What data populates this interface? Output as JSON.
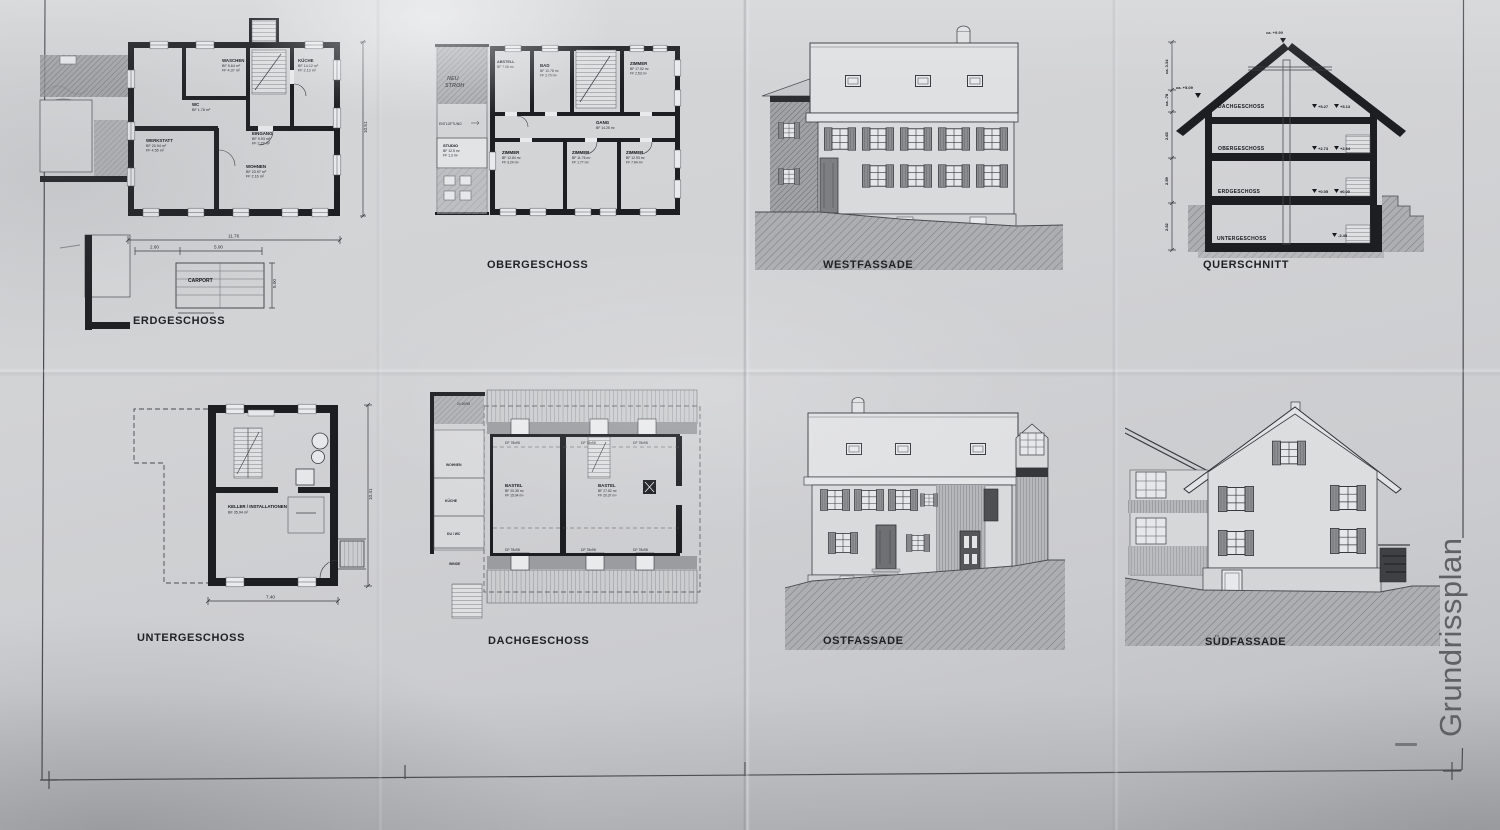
{
  "page": {
    "vertical_title": "Grundrissplan"
  },
  "erdgeschoss": {
    "title": "ERDGESCHOSS",
    "carport": "CARPORT",
    "rooms": {
      "waschen": {
        "name": "WASCHEN",
        "a": "BF 5.64 m²",
        "b": "FF 4.37 m²"
      },
      "kueche": {
        "name": "KÜCHE",
        "a": "BF 14.12 m²",
        "b": "FF 2.13 m²"
      },
      "wc": {
        "name": "WC",
        "a": "BF 1.78 m²"
      },
      "eingang": {
        "name": "EINGANG",
        "a": "BF 9.93 m²",
        "b": "FF 2.27 m²"
      },
      "werkstatt": {
        "name": "WERKSTATT",
        "a": "BF 20.94 m²",
        "b": "FF 4.55 m²"
      },
      "wohnen": {
        "name": "WOHNEN",
        "a": "BF 23.97 m²",
        "b": "FF 2.16 m²"
      }
    },
    "dims": {
      "total": "11.76",
      "left": "2.60",
      "mid": "5.00",
      "right_height": "10.51",
      "carport_depth": "5.00"
    }
  },
  "obergeschoss": {
    "title": "OBERGESCHOSS",
    "rooms": {
      "abstell": {
        "name": "ABSTELL",
        "a": "BF 7.08 m²"
      },
      "bad": {
        "name": "BAD",
        "a": "BF 10.78 m²",
        "b": "FF 2.70 m²"
      },
      "zno": {
        "name": "ZIMMER",
        "a": "BF 17.52 m²",
        "b": "FF 2.53 m²"
      },
      "gang": {
        "name": "GANG",
        "a": "BF 14.25 m²"
      },
      "z1": {
        "name": "ZIMMER",
        "a": "BF 12.84 m²",
        "b": "FF 3.24 m²"
      },
      "z2": {
        "name": "ZIMMER",
        "a": "BF 11.76 m²",
        "b": "FF 1.77 m²"
      },
      "z3": {
        "name": "ZIMMER",
        "a": "BF 12.93 m²",
        "b": "FF 7.94 m²"
      },
      "studio": {
        "name": "STUDIO",
        "a": "BF 12.5 m²",
        "b": "FF 1.3 m²"
      }
    },
    "notes": {
      "line1": "NEU",
      "line2": "STROH",
      "ent": "ENTLÜFTUNG"
    }
  },
  "westfassade": {
    "title": "WESTFASSADE"
  },
  "querschnitt": {
    "title": "QUERSCHNITT",
    "floors": {
      "dach": "DACHGESCHOSS",
      "ober": "OBERGESCHOSS",
      "erd": "ERDGESCHOSS",
      "unter": "UNTERGESCHOSS"
    },
    "levels": {
      "ridge": "ca. +9.99",
      "eaves": "ca. +5.09",
      "dach_a": "+5.27",
      "dach_b": "+5.13",
      "ober_a": "+2.73",
      "ober_b": "+2.64",
      "erd_a": "+0.05",
      "erd_b": "±0.00",
      "unter": "-2.45"
    },
    "dims": {
      "roof": "ca. 3.34",
      "knee": "ca. .78",
      "d1": "2.65",
      "d2": "2.59",
      "d3": "2.52"
    }
  },
  "untergeschoss": {
    "title": "UNTERGESCHOSS",
    "room": {
      "name": "KELLER / INSTALLATIONEN",
      "a": "BF 35.94 m²"
    },
    "dims": {
      "width": "7.40",
      "height": "10.41"
    }
  },
  "dachgeschoss": {
    "title": "DACHGESCHOSS",
    "window_label": "DF 78x98",
    "note_top": "2x 60/98",
    "rooms": {
      "w": {
        "name": "BASTEL",
        "a": "BF 20.35 m²",
        "b": "FF 15.04 m²"
      },
      "e": {
        "name": "BASTEL",
        "a": "BF 27.82 m²",
        "b": "FF 20.37 m²"
      }
    },
    "side": {
      "wohnen": "WOHNEN",
      "kueche": "KÜCHE",
      "duwc": "DU / WC",
      "winde": "WINDE"
    }
  },
  "ostfassade": {
    "title": "OSTFASSADE"
  },
  "suedfassade": {
    "title": "SÜDFASSADE"
  }
}
